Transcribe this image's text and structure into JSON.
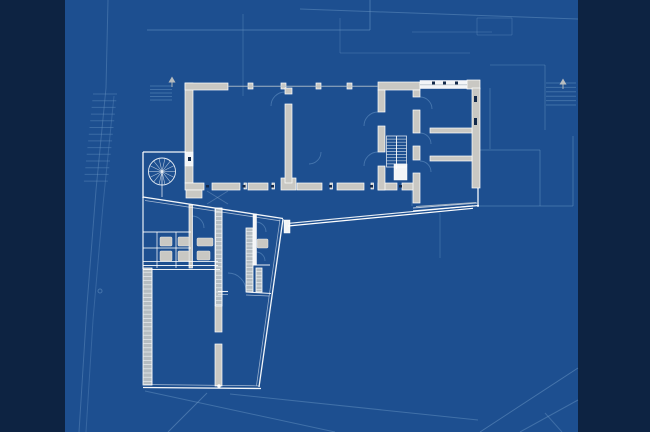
{
  "meta": {
    "type": "architectural-floor-plan-blueprint",
    "canvas_width": 650,
    "canvas_height": 432
  },
  "palette": {
    "field": "#1d4f90",
    "side_band": "#0d2342",
    "site_line": "#6d99c6",
    "wall_fill": "#c9c8c3",
    "wall_stroke": "#ffffff",
    "white_wall": "#f3f5f7",
    "glass_dark": "#13294a",
    "glass_line": "#b7c3cd",
    "arc_line": "#7aa6d2",
    "rung_line": "#eef2f5",
    "landing": "#eef2f6",
    "fixture_fill": "#c9c8c3"
  },
  "side_bands": [
    {
      "x": 0,
      "y": 0,
      "w": 65,
      "h": 432
    },
    {
      "x": 578,
      "y": 0,
      "w": 72,
      "h": 432
    }
  ],
  "site": {
    "lines": [
      [
        147,
        30,
        370,
        30,
        1,
        0.5
      ],
      [
        370,
        0,
        370,
        30,
        1,
        0.5
      ],
      [
        300,
        9,
        578,
        19,
        1,
        0.45
      ],
      [
        243,
        14,
        243,
        96,
        1,
        0.35
      ],
      [
        108,
        0,
        106,
        88,
        1,
        0.4
      ],
      [
        490,
        88,
        490,
        149,
        1,
        0.4
      ],
      [
        478,
        150,
        540,
        150,
        1,
        0.45
      ],
      [
        540,
        150,
        540,
        206,
        1,
        0.45
      ],
      [
        478,
        206,
        573,
        206,
        1,
        0.45
      ],
      [
        573,
        136,
        573,
        206,
        1,
        0.45
      ],
      [
        545,
        65,
        545,
        130,
        1,
        0.4
      ],
      [
        490,
        65,
        545,
        65,
        1,
        0.35
      ],
      [
        207,
        393,
        168,
        432,
        1,
        0.5
      ],
      [
        145,
        391,
        335,
        432,
        1,
        0.45
      ],
      [
        230,
        394,
        478,
        420,
        1,
        0.45
      ],
      [
        480,
        432,
        578,
        368,
        1,
        0.5
      ],
      [
        520,
        432,
        578,
        400,
        1,
        0.45
      ],
      [
        545,
        413,
        562,
        432,
        1,
        0.4
      ],
      [
        340,
        18,
        340,
        53,
        1,
        0.3
      ],
      [
        340,
        53,
        470,
        53,
        1,
        0.3
      ],
      [
        412,
        32,
        492,
        32,
        1,
        0.3
      ],
      [
        477,
        18,
        512,
        18,
        1,
        0.3
      ],
      [
        512,
        18,
        512,
        35,
        1,
        0.3
      ],
      [
        477,
        35,
        512,
        35,
        1,
        0.3
      ],
      [
        477,
        18,
        477,
        35,
        1,
        0.3
      ],
      [
        440,
        213,
        440,
        258,
        1,
        0.35
      ]
    ],
    "contours": [
      {
        "points": "106,88 96,190 87,305 79,432",
        "opacity": 0.4
      },
      {
        "points": "114,96 103,205 93,320 86,432",
        "opacity": 0.32
      }
    ],
    "tick_groups": [
      {
        "x": 93,
        "w": 24,
        "y0": 94,
        "dy": 6.7,
        "n": 14,
        "drift": -0.7,
        "opacity": 0.38
      },
      {
        "x": 150,
        "w": 22,
        "y0": 86,
        "dy": 3.5,
        "n": 5,
        "drift": 0,
        "opacity": 0.45
      },
      {
        "x": 546,
        "w": 30,
        "y0": 83,
        "dy": 4.4,
        "n": 6,
        "drift": 0,
        "opacity": 0.45
      }
    ],
    "arrows": [
      {
        "x": 172,
        "y": 80
      },
      {
        "x": 563,
        "y": 82
      }
    ],
    "circles": [
      {
        "cx": 100,
        "cy": 291,
        "r": 2
      }
    ]
  },
  "building": {
    "wall_rects": [
      [
        185,
        83,
        8,
        100
      ],
      [
        185,
        83,
        43,
        7
      ],
      [
        248,
        83,
        5,
        6
      ],
      [
        281,
        83,
        5,
        6
      ],
      [
        316,
        83,
        5,
        6
      ],
      [
        347,
        83,
        5,
        6
      ],
      [
        378,
        82,
        42,
        8
      ],
      [
        467,
        80,
        13,
        9
      ],
      [
        472,
        88,
        8,
        100
      ],
      [
        185,
        183,
        19,
        7
      ],
      [
        212,
        183,
        28,
        7
      ],
      [
        248,
        183,
        20,
        7
      ],
      [
        297,
        183,
        25,
        7
      ],
      [
        337,
        183,
        27,
        7
      ],
      [
        378,
        183,
        19,
        7
      ],
      [
        402,
        183,
        16,
        7
      ],
      [
        281,
        178,
        15,
        12
      ],
      [
        244,
        183,
        2.5,
        6
      ],
      [
        272,
        183,
        2.5,
        6
      ],
      [
        330,
        183,
        2.5,
        6
      ],
      [
        371,
        183,
        2.5,
        6
      ],
      [
        285,
        88,
        7,
        6
      ],
      [
        285,
        104,
        7,
        79
      ],
      [
        378,
        90,
        7,
        22
      ],
      [
        378,
        126,
        7,
        26
      ],
      [
        378,
        166,
        7,
        24
      ],
      [
        413,
        90,
        7,
        7
      ],
      [
        413,
        110,
        7,
        23
      ],
      [
        413,
        146,
        7,
        14
      ],
      [
        413,
        173,
        7,
        30
      ],
      [
        430,
        128,
        42,
        5
      ],
      [
        430,
        156,
        42,
        5
      ],
      [
        189,
        205,
        3.5,
        63
      ],
      [
        215,
        306,
        7,
        26
      ],
      [
        215,
        344,
        7,
        42
      ],
      [
        186,
        190,
        16,
        8
      ]
    ],
    "white_rects": [
      [
        420,
        80.5,
        47,
        8
      ],
      [
        394,
        164,
        13,
        16
      ],
      [
        253,
        214,
        3.5,
        51
      ],
      [
        284,
        220,
        6,
        13
      ],
      [
        185,
        152,
        8,
        14
      ]
    ],
    "thin_walls": [
      [
        143,
        152,
        186,
        152,
        1.3,
        0.95
      ],
      [
        143,
        152,
        143,
        198,
        1.3,
        0.95
      ],
      [
        143,
        197,
        143,
        269,
        1.2,
        0.9
      ],
      [
        143,
        197,
        283,
        218.5,
        1.3,
        0.95
      ],
      [
        145,
        200.5,
        280,
        220.8,
        0.8,
        0.6
      ],
      [
        283,
        219,
        259,
        387,
        1.3,
        0.95
      ],
      [
        280,
        219.5,
        256.5,
        385.5,
        0.8,
        0.55
      ],
      [
        143,
        387.5,
        261,
        388.5,
        1.3,
        0.95
      ],
      [
        144,
        384.5,
        259,
        385.8,
        0.8,
        0.6
      ],
      [
        288,
        226,
        473,
        208.3,
        1.2,
        1
      ],
      [
        289,
        223.3,
        473,
        205.8,
        1.2,
        0.9
      ],
      [
        413,
        211,
        479,
        205.5,
        1.2,
        0.95
      ],
      [
        413,
        208,
        477,
        203,
        0.9,
        0.7
      ],
      [
        478,
        188,
        478,
        207,
        1.4,
        0.9
      ],
      [
        143,
        232,
        191,
        232,
        1,
        0.9
      ],
      [
        157,
        232,
        157,
        268,
        0.9,
        0.8
      ],
      [
        176,
        232,
        176,
        268,
        0.9,
        0.8
      ],
      [
        143,
        248,
        191,
        248,
        0.9,
        0.8
      ],
      [
        143,
        261.5,
        218,
        261.5,
        0.9,
        0.8
      ],
      [
        143,
        265.5,
        218,
        265.5,
        1,
        0.9
      ],
      [
        143,
        269.5,
        220,
        269.5,
        1,
        0.9
      ],
      [
        215,
        208,
        215,
        306,
        0.9,
        0.85
      ],
      [
        222,
        208,
        222,
        306,
        0.9,
        0.85
      ],
      [
        253,
        265,
        270,
        265,
        1.1,
        0.9
      ],
      [
        218,
        291.5,
        228,
        291.5,
        1.1,
        0.9
      ],
      [
        246,
        292,
        271,
        293.5,
        1.1,
        0.9
      ],
      [
        218,
        294.5,
        228,
        294.5,
        0.8,
        0.6
      ],
      [
        246,
        295,
        269,
        296,
        0.8,
        0.6
      ],
      [
        152,
        268,
        152,
        385,
        0.9,
        0.8
      ]
    ],
    "glass_lines": [
      [
        228,
        86.2,
        378,
        86.2
      ],
      [
        420,
        84.8,
        467,
        84.8
      ],
      [
        416,
        206.5,
        476,
        202.5
      ]
    ],
    "window_ticks": [
      [
        206,
        185,
        3,
        2.5
      ],
      [
        242.5,
        185,
        3,
        2.5
      ],
      [
        271,
        185,
        3,
        2.5
      ],
      [
        329,
        185,
        3,
        2.5
      ],
      [
        370,
        185,
        3,
        2.5
      ],
      [
        399,
        185,
        3,
        2.5
      ],
      [
        432,
        81.5,
        3,
        3
      ],
      [
        443,
        81.5,
        3,
        3
      ],
      [
        455,
        81.5,
        3,
        3
      ],
      [
        188,
        157,
        3,
        4
      ],
      [
        474,
        96,
        3,
        6
      ],
      [
        474,
        118,
        3,
        7
      ]
    ],
    "fixtures": [
      [
        160,
        237,
        12,
        9
      ],
      [
        178,
        237,
        11,
        9
      ],
      [
        160,
        251,
        12,
        10
      ],
      [
        178,
        251,
        11,
        10
      ],
      [
        197,
        238,
        16,
        8
      ],
      [
        197,
        251,
        13,
        9
      ],
      [
        257,
        239,
        11,
        9
      ]
    ],
    "rung_strips": [
      {
        "x": 215.5,
        "y": 208,
        "w": 6.5,
        "h": 98,
        "step": 4.2
      },
      {
        "x": 246,
        "y": 228,
        "w": 7,
        "h": 64,
        "step": 3.6
      },
      {
        "x": 256,
        "y": 268,
        "w": 6,
        "h": 24,
        "step": 3.6
      },
      {
        "x": 143,
        "y": 268,
        "w": 9,
        "h": 117,
        "step": 4.2
      }
    ],
    "u_stair": {
      "x": 386.5,
      "y": 136,
      "w": 20,
      "h": 31,
      "treads": 9,
      "divider_x": 396.5
    },
    "spiral_stair": {
      "cx": 162,
      "cy": 171.5,
      "r": 13.5,
      "spokes": 14,
      "tail": [
        162,
        171.5,
        162,
        197
      ]
    },
    "door_arcs": [
      "M285,92 A14,14 0 0 0 271,106",
      "M378,112 A14,14 0 0 0 364,126",
      "M378,152 A14,14 0 0 0 364,166",
      "M420,97 A12,12 0 0 1 432,109",
      "M420,133 A11,11 0 0 1 431,144",
      "M420,161 A11,11 0 0 1 431,172",
      "M192,216 A12,12 0 0 1 204,228",
      "M256,222 A10,10 0 0 1 266,232",
      "M256,252 A9,9 0 0 1 265,261",
      "M246,291 A18,18 0 0 0 228,273",
      "M321,152 A12,12 0 0 1 309,164"
    ],
    "faint_lines": [
      [
        207,
        191,
        228,
        204,
        0.8,
        0.35
      ],
      [
        228,
        191,
        207,
        204,
        0.8,
        0.35
      ],
      [
        412,
        190,
        412,
        206,
        0.8,
        0.4
      ]
    ],
    "pivot_dot": {
      "cx": 219,
      "cy": 386,
      "r": 1.8
    }
  }
}
